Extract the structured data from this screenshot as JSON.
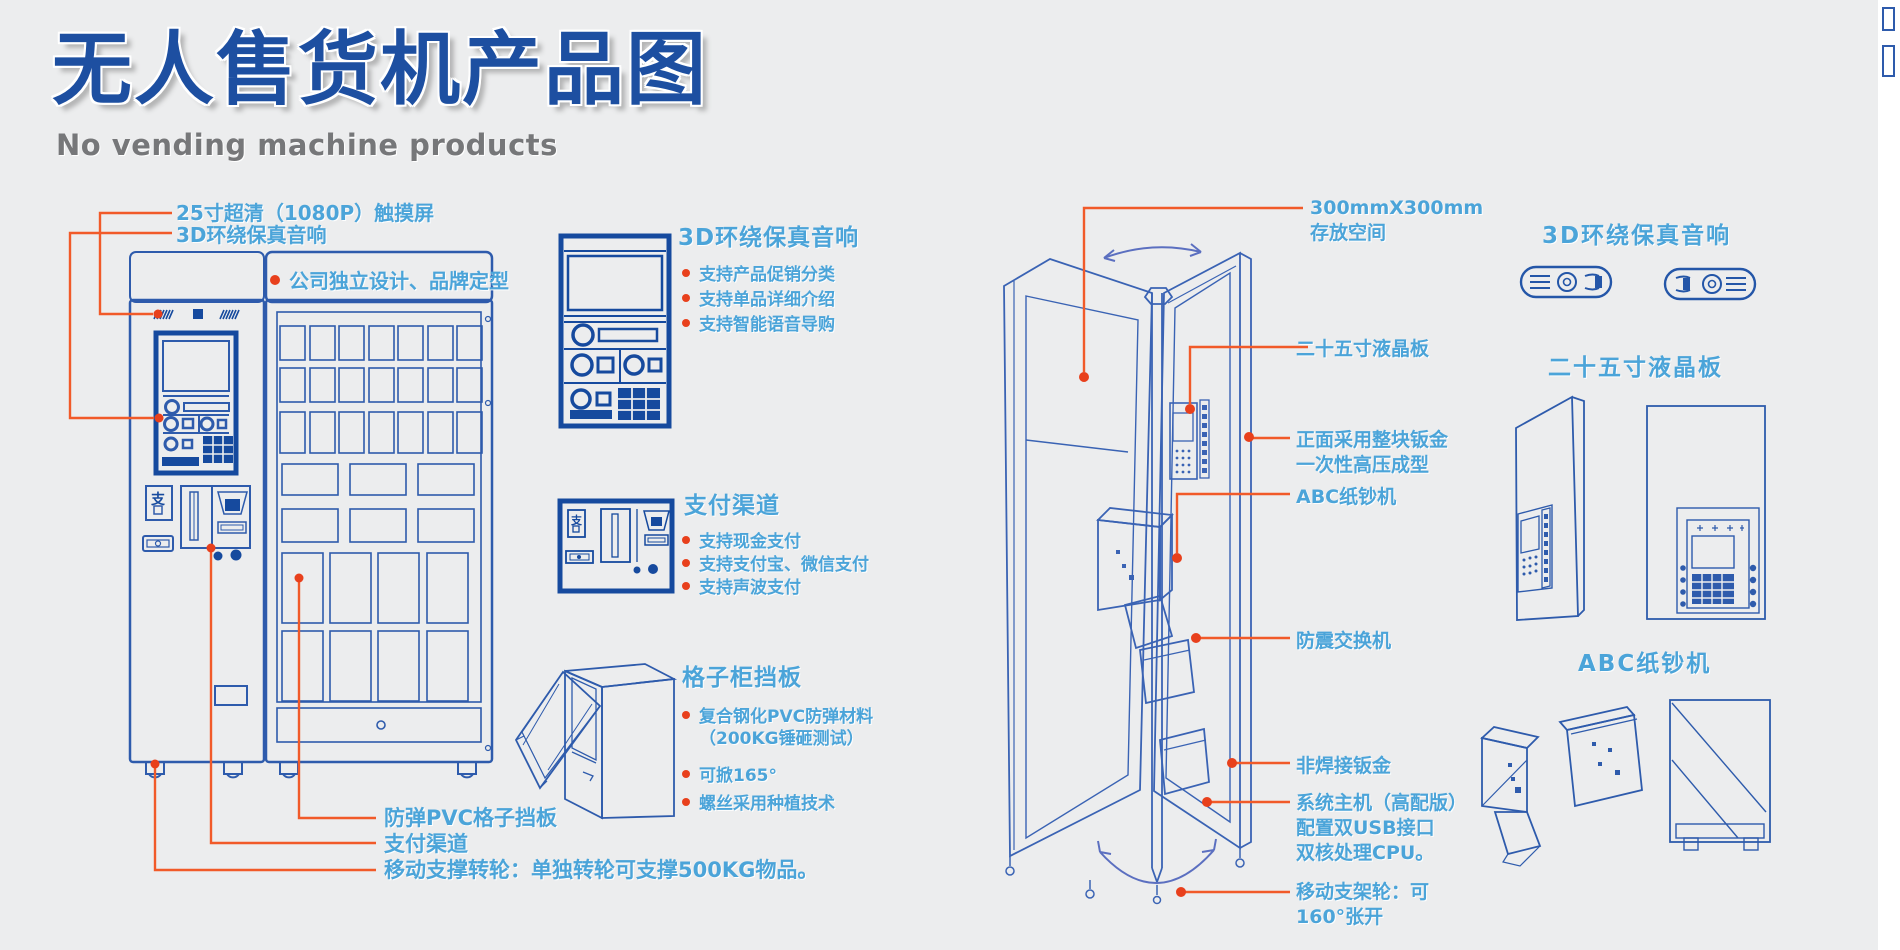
{
  "header": {
    "title": "无人售货机产品图",
    "subtitle": "No vending machine products"
  },
  "front_machine": {
    "pay_glyph": "支",
    "callouts_top": [
      {
        "label": "25寸超清（1080P）触摸屏"
      },
      {
        "label": "3D环绕保真音响"
      }
    ],
    "brand_note": "公司独立设计、品牌定型",
    "callouts_bottom": [
      {
        "label": "防弹PVC格子挡板"
      },
      {
        "label": "支付渠道"
      },
      {
        "label": "移动支撑转轮：单独转轮可支撑500KG物品。"
      }
    ]
  },
  "features": [
    {
      "title": "3D环绕保真音响",
      "items": [
        "支持产品促销分类",
        "支持单品详细介绍",
        "支持智能语音导购"
      ]
    },
    {
      "title": "支付渠道",
      "items": [
        "支持现金支付",
        "支持支付宝、微信支付",
        "支持声波支付"
      ]
    },
    {
      "title": "格子柜挡板",
      "items": [
        "复合钢化PVC防弹材料\n（200KG锤砸测试）",
        "可掀165°",
        "螺丝采用种植技术"
      ]
    }
  ],
  "open_machine": {
    "callouts": [
      "300mmX300mm\n存放空间",
      "二十五寸液晶板",
      "正面采用整块钣金\n一次性高压成型",
      "ABC纸钞机",
      "防震交换机",
      "非焊接钣金",
      "系统主机（高配版）\n配置双USB接口\n双核处理CPU。",
      "移动支架轮：可\n160°张开"
    ]
  },
  "detail_panels": [
    {
      "title": "3D环绕保真音响"
    },
    {
      "title": "二十五寸液晶板"
    },
    {
      "title": "ABC纸钞机"
    }
  ],
  "colors": {
    "deep_blue": "#1d4fa1",
    "drawing_blue": "#2e5bac",
    "sky_blue": "#4ba4d9",
    "line_orange": "#f15a29",
    "bullet_red": "#e8401c"
  }
}
